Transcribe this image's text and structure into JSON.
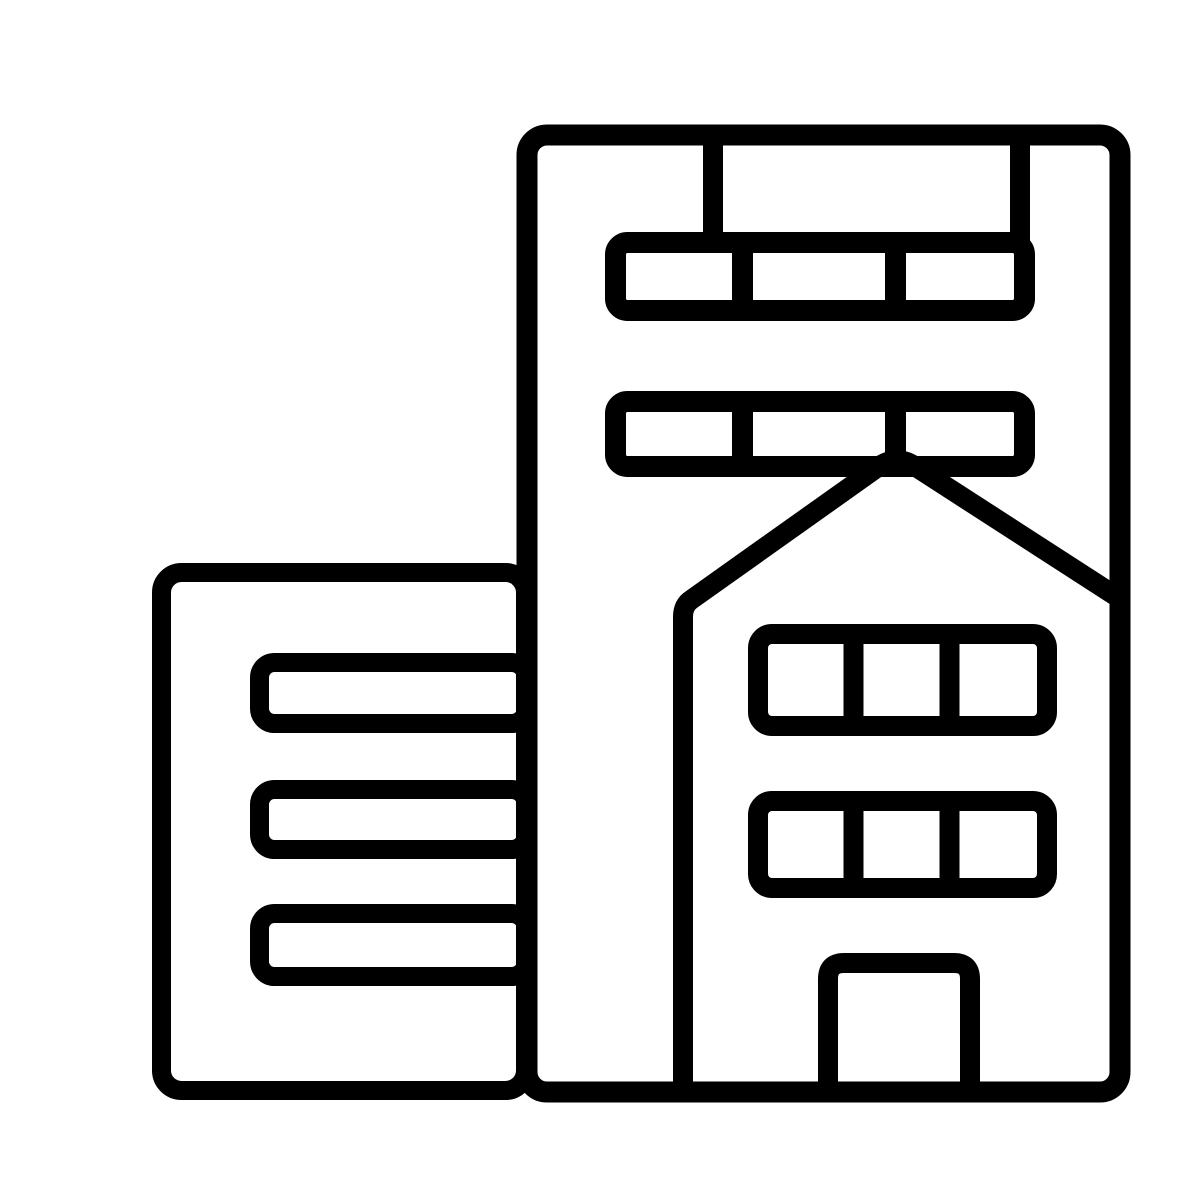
{
  "icon": {
    "label": "city-buildings-icon",
    "description": "Black outline glyph of two adjoining buildings: a tall office tower with two rows of three windows, an overlapping house-shaped front with a peaked roof, two rows of three windows and a door, and a shorter side building with three horizontal window bars",
    "type": "glyph-icon",
    "colors": {
      "ink": "#000000",
      "background": "#ffffff"
    },
    "elements": {
      "tall_building": {
        "name": "tall-building",
        "window_rows": 2,
        "panes_per_row": 3,
        "roof_columns": 2
      },
      "house_front": {
        "name": "house-front",
        "window_rows": 2,
        "panes_per_row": 3,
        "doors": 1
      },
      "side_building": {
        "name": "side-building",
        "window_bars": 3
      }
    }
  }
}
